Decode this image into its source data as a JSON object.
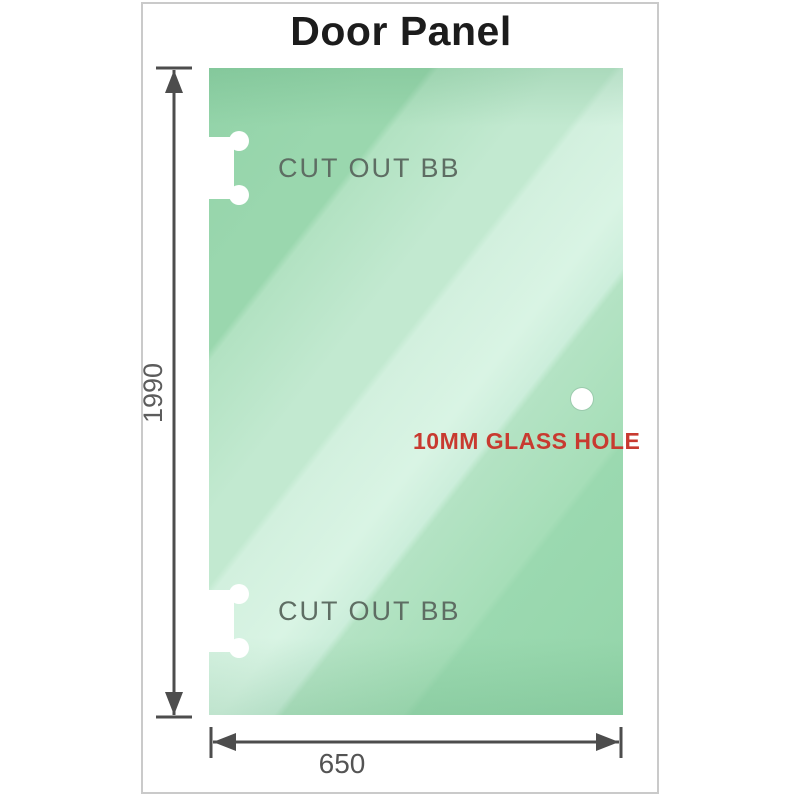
{
  "title": "Door Panel",
  "panel": {
    "cutouts": [
      {
        "label": "CUT OUT BB"
      },
      {
        "label": "CUT OUT BB"
      }
    ],
    "hole_label": "10MM GLASS HOLE"
  },
  "dimensions": {
    "height": "1990",
    "width": "650"
  },
  "colors": {
    "glass_base": "#8fd2a6",
    "glass_highlight": "#d9f4e4",
    "cutout_label": "#5e6d63",
    "hole_label_red": "#c83a30",
    "dimension_line": "#4d4d4d",
    "dimension_text": "#5c5c5c",
    "frame_border": "#cacaca",
    "title_color": "#1c1c1c"
  }
}
